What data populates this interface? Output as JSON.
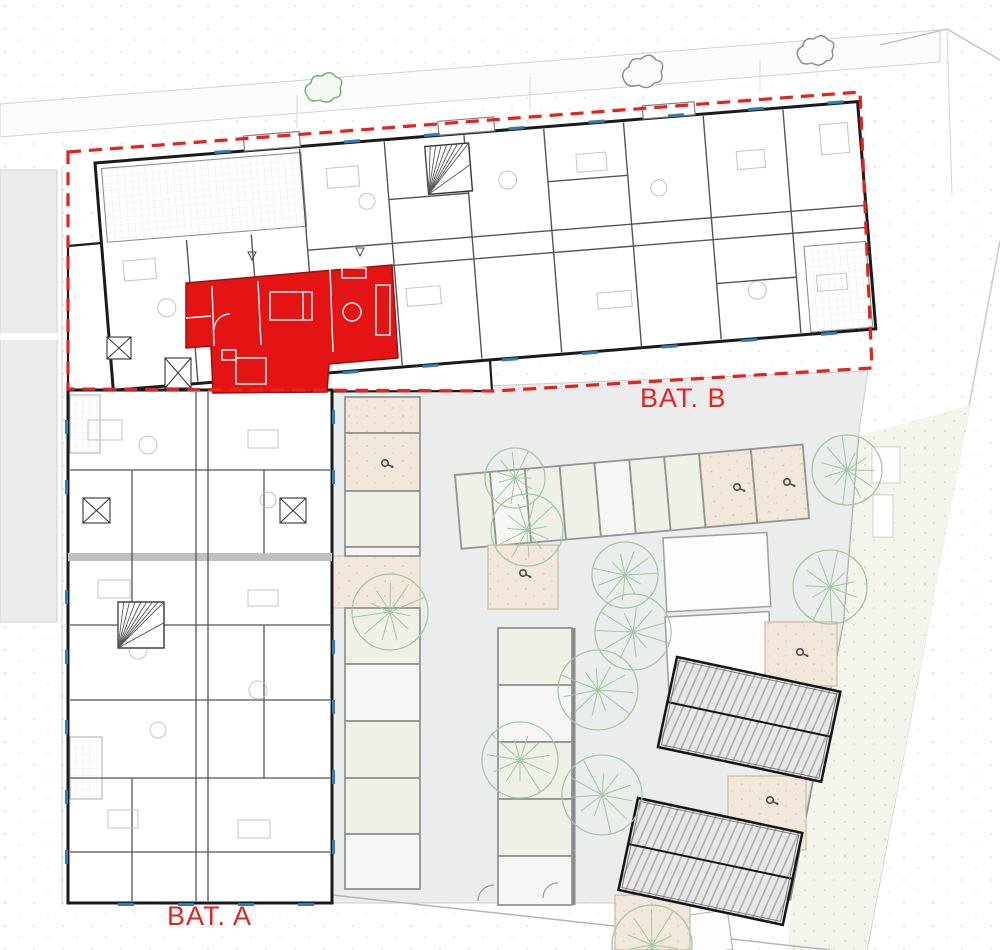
{
  "page": {
    "title": "Residential site plan with highlighted apartment"
  },
  "labels": {
    "building_b": "BAT. B",
    "building_a": "BAT. A"
  },
  "colors": {
    "highlight_red": "#e41414",
    "highlight_red_dark": "#9c0f0f",
    "boundary_red": "#e8211d",
    "label_red": "#e8211d",
    "tree_green": "#9fc9a3",
    "bush_green": "#6faf74",
    "bush_gray": "#8a8a8a",
    "paving_gray": "#ebedec",
    "stall_green": "#eff1e9",
    "stall_white": "#f6f7f4",
    "pad_beige": "#f1e7da",
    "lawn_green": "#f3f4ec",
    "wall_dark": "#1a1a1a",
    "wall_mid": "#555555",
    "furniture_gray": "#c4c4c4",
    "window_blue": "#2f7db6",
    "divider_gray": "#949494"
  },
  "icons": {
    "tree": "tree-canopy-icon",
    "parking_marker": "parking-marker-icon",
    "stair": "stair-fan-icon",
    "bush": "bush-sketch-icon",
    "window_shutter": "x-shutter-icon"
  }
}
